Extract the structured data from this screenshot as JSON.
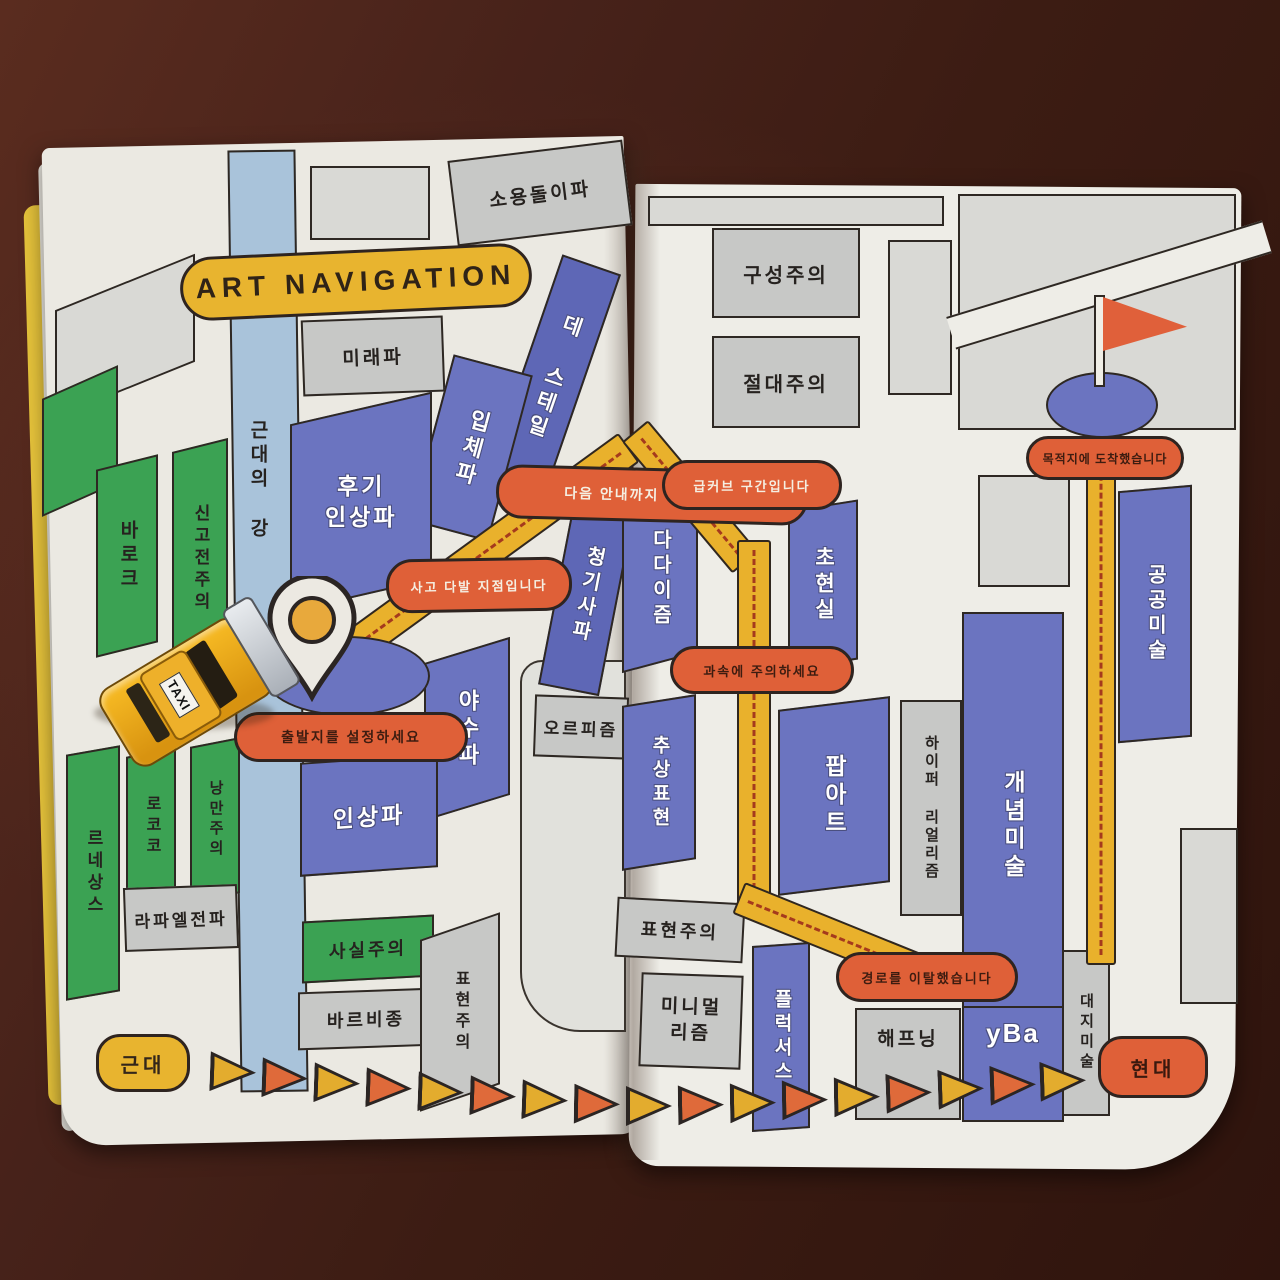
{
  "banner": {
    "title": "ART NAVIGATION"
  },
  "badges": {
    "start": "근대",
    "end": "현대"
  },
  "callouts": {
    "go_straight": "다음 안내까지 직진입니다",
    "accident_zone": "사고 다발 지점입니다",
    "set_departure": "출발지를 설정하세요",
    "sharp_curve": "급커브 구간입니다",
    "watch_speed": "과속에 주의하세요",
    "arrived": "목적지에 도착했습니다",
    "off_route": "경로를 이탈했습니다"
  },
  "blocks": {
    "vorticism": "소용돌이파",
    "futurism": "미래파",
    "de_stijl": "데 스테일",
    "cubism": "입체파",
    "post_impressionism": "후기\n인상파",
    "modern_river": "근대의 강",
    "baroque": "바로크",
    "neoclassicism": "신고전주의",
    "blue_rider": "청기사파",
    "fauvism": "야수파",
    "orphism": "오르피즘",
    "impressionism": "인상파",
    "rococo": "로코코",
    "romanticism": "낭만주의",
    "renaissance": "르네상스",
    "pre_raphaelites": "라파엘전파",
    "realism": "사실주의",
    "barbizon": "바르비종",
    "expressionism_left": "표현주의",
    "constructivism": "구성주의",
    "suprematism": "절대주의",
    "dadaism": "다다이즘",
    "surrealism": "초현실",
    "public_art": "공공미술",
    "abstract_expressionism": "추상표현",
    "pop_art": "팝아트",
    "hyperrealism": "하이퍼 리얼리즘",
    "conceptual_art": "개념미술",
    "expressionism_right": "표현주의",
    "minimalism": "미니멀\n리즘",
    "fluxus": "플럭서스",
    "happening": "해프닝",
    "yba": "yBa",
    "land_art": "대지미술"
  },
  "taxi": {
    "roof_label": "TAXI"
  },
  "colors": {
    "paper": "#ebe9e2",
    "block_blue": "#6b74c0",
    "block_green": "#3ba253",
    "block_gray": "#c7c8c6",
    "river_blue": "#a9c3da",
    "route_yellow": "#e9b12c",
    "callout_orange": "#df6038",
    "badge_yellow": "#e8b42f",
    "wood_brown": "#47221a"
  }
}
